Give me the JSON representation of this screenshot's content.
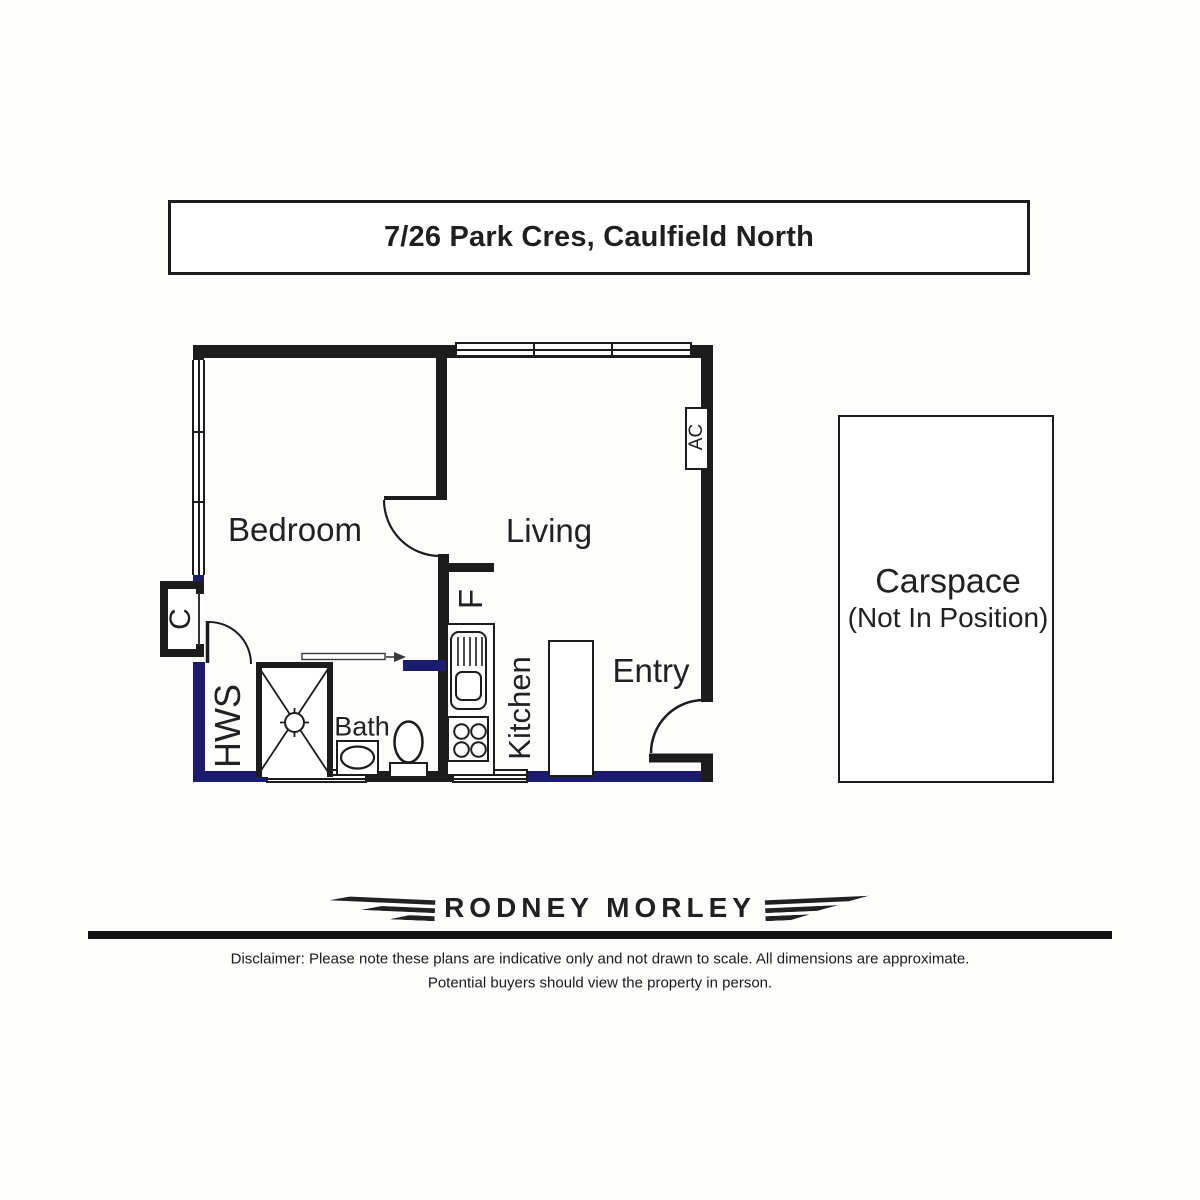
{
  "header": {
    "title": "7/26 Park Cres, Caulfield North"
  },
  "floorplan": {
    "labels": {
      "bedroom": "Bedroom",
      "living": "Living",
      "kitchen": "Kitchen",
      "bath": "Bath",
      "entry": "Entry",
      "hws": "HWS",
      "closet": "C",
      "fridge": "F",
      "air_conditioner": "AC"
    },
    "carspace": {
      "title": "Carspace",
      "subtitle": "(Not In Position)"
    }
  },
  "footer": {
    "agency_logo_text": "RODNEY MORLEY",
    "disclaimer_line1": "Disclaimer: Please note these plans are indicative only and not drawn to scale. All dimensions are approximate.",
    "disclaimer_line2": "Potential buyers should view the property in person."
  },
  "colors": {
    "wall_black": "#1c1c1c",
    "wall_navy": "#1b1c6e"
  }
}
